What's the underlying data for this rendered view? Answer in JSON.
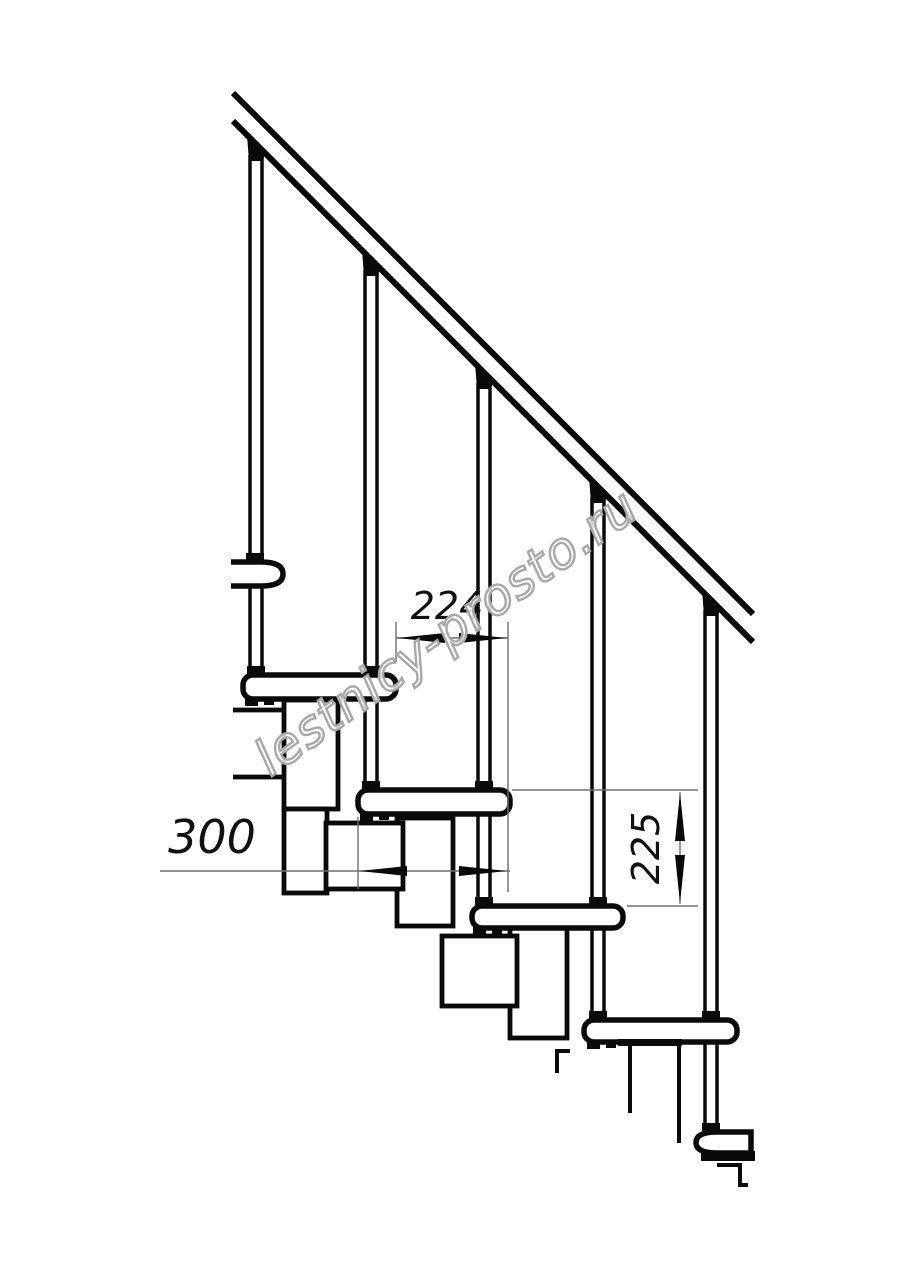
{
  "page": {
    "background": "#ffffff"
  },
  "colors": {
    "line": "#0a0a0a",
    "paper": "#ffffff",
    "thin": "#6e6e6e",
    "text": "#111111",
    "watermark_fill": "rgba(255,255,255,0.84)",
    "watermark_stroke": "#a8a8a8"
  },
  "dimensions": {
    "tread_run": {
      "label": "224"
    },
    "tread_depth": {
      "label": "300"
    },
    "riser_height": {
      "label": "225"
    }
  },
  "watermark": {
    "text": "lestnicy-prosto.ru"
  }
}
